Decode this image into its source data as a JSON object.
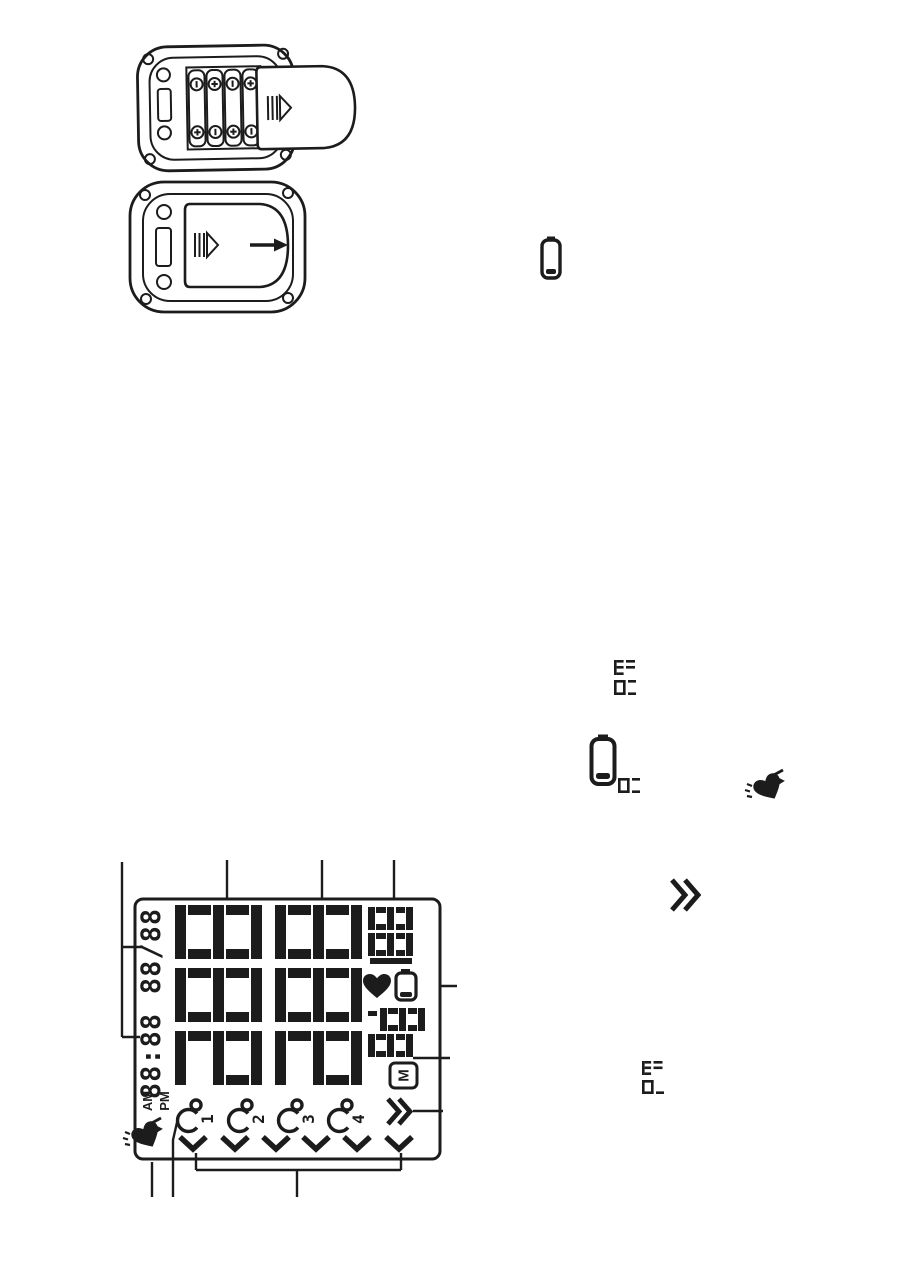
{
  "page": {
    "background": "#ffffff",
    "ink": "#1c1c1c"
  },
  "figures": {
    "battery_open": {
      "name": "battery-compartment-open-with-batteries",
      "battery_count": 4,
      "terminal_marks": [
        "-",
        "+",
        "+",
        "-",
        "-",
        "+"
      ]
    },
    "battery_closed": {
      "name": "battery-cover-closed-slide-direction"
    }
  },
  "margin_icons": {
    "battery_low_small": "battery-low-icon",
    "lcd_am": "AM",
    "battery_low_large": "battery-low-icon",
    "lcd_a": "A",
    "pulse_heart": "irregular-heartbeat-icon",
    "forward": "fast-forward-icon",
    "lcd_pm": "PM"
  },
  "lcd": {
    "date": "88/88",
    "time": "88:88",
    "am": "AM",
    "pm": "PM",
    "large_digit_rows": "3",
    "pulse_digits": "188",
    "memory_digits": "88",
    "memory_badge": "M",
    "users": [
      "1",
      "2",
      "3",
      "4"
    ],
    "check_count": "6"
  }
}
